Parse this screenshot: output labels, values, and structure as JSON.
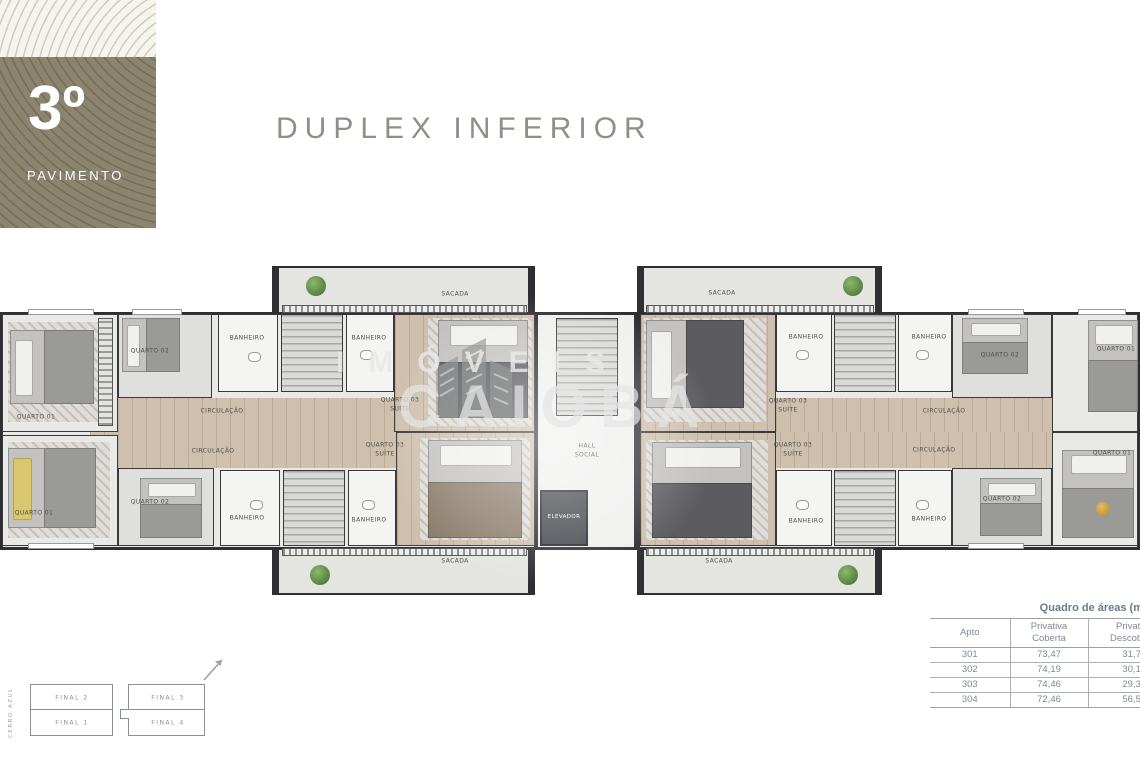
{
  "header": {
    "floor_number": "3º",
    "floor_label": "PAVIMENTO",
    "title": "DUPLEX INFERIOR"
  },
  "watermark": {
    "brand_top": "IMÓVEIS",
    "brand_main": "CAIOBÁ"
  },
  "plan": {
    "rooms": {
      "quarto01": "QUARTO 01",
      "quarto02": "QUARTO 02",
      "quarto03": "QUARTO 03",
      "suite": "SUÍTE",
      "banheiro": "BANHEIRO",
      "circulacao": "CIRCULAÇÃO",
      "sacada": "SACADA",
      "hall1": "HALL",
      "hall2": "SOCIAL",
      "elevador": "ELEVADOR"
    }
  },
  "key_plan": {
    "street": "CERRO AZUL",
    "top_left": "FINAL 2",
    "top_right": "FINAL 3",
    "bottom_left": "FINAL 1",
    "bottom_right": "FINAL 4"
  },
  "area_table": {
    "title": "Quadro de áreas (m²)",
    "columns": [
      {
        "l1": "Apto",
        "l2": ""
      },
      {
        "l1": "Privativa",
        "l2": "Coberta"
      },
      {
        "l1": "Privativa",
        "l2": "Descoberta"
      }
    ],
    "rows": [
      [
        "301",
        "73,47",
        "31,70"
      ],
      [
        "302",
        "74,19",
        "30,17"
      ],
      [
        "303",
        "74,46",
        "29,32"
      ],
      [
        "304",
        "72,46",
        "56,55"
      ]
    ]
  },
  "colors": {
    "accent_olive": "#8b8570",
    "wall": "#2e2e33",
    "wood": "#cfc0ad",
    "table_text": "#7f8a95",
    "title_text": "#8f8f88"
  }
}
